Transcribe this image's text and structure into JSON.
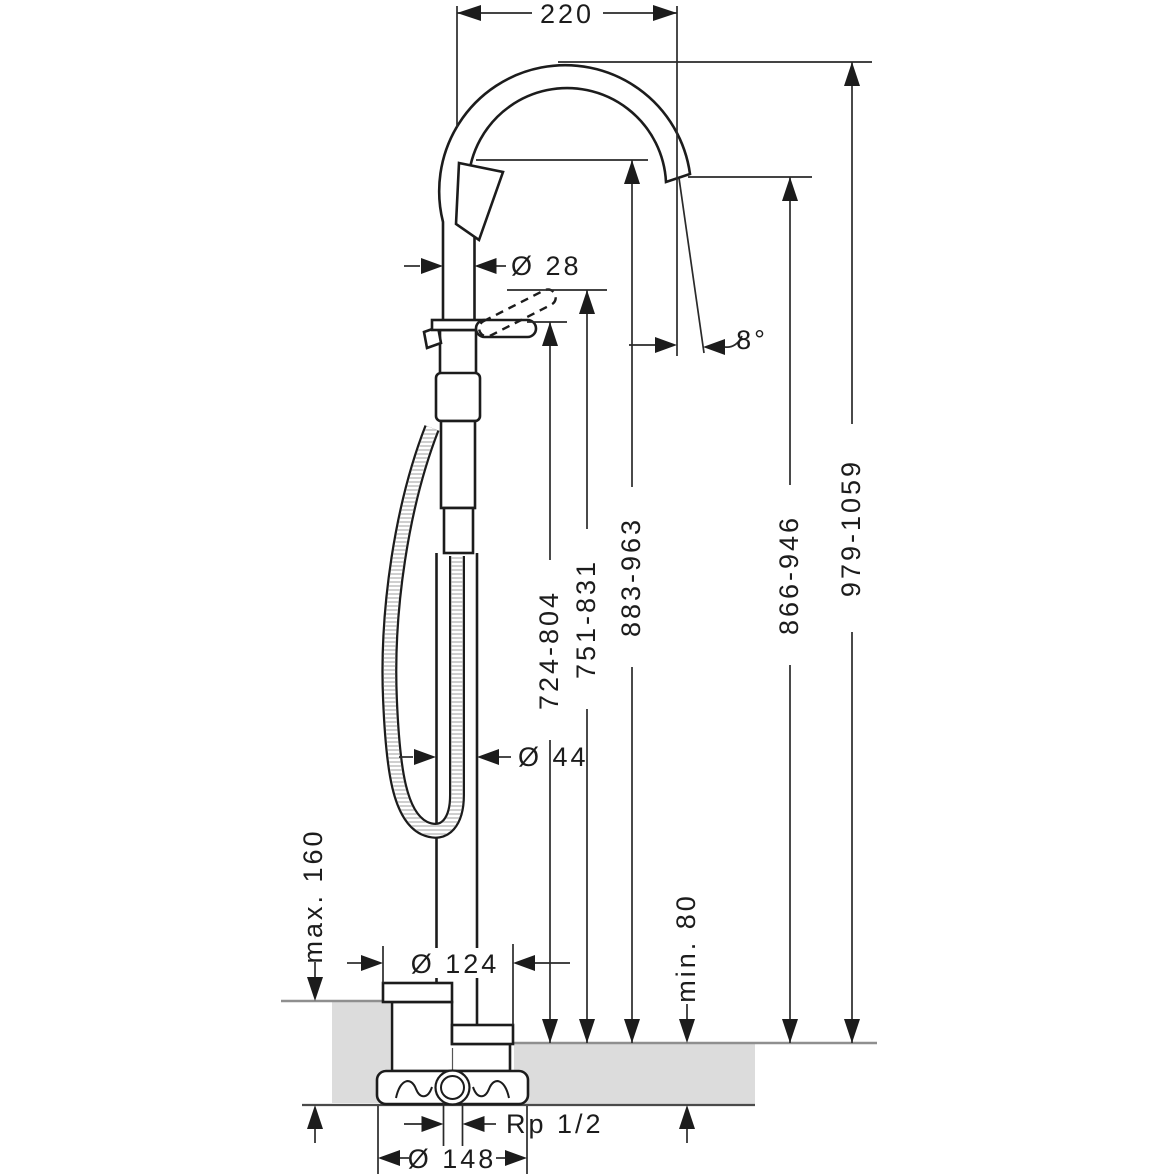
{
  "drawing": {
    "type": "technical-dimension-drawing",
    "subject": "freestanding bath mixer with hand shower, floor-mounted",
    "colors": {
      "line": "#1c1c1c",
      "dimension_line": "#2a2a2a",
      "floor_fill": "#dcdcdc",
      "floor_edge": "#8f8f8f",
      "background": "#ffffff"
    },
    "dimensions": {
      "top_width": "220",
      "pipe_diameter": "Ø 28",
      "spout_angle": "8°",
      "handle_height_range": "724-804",
      "handle_raised_height_range": "751-831",
      "spout_outlet_height_range": "883-963",
      "spout_tip_height_range": "866-946",
      "total_height_range": "979-1059",
      "column_diameter": "Ø 44",
      "floor_buildup_max": "max. 160",
      "floor_buildup_min": "min. 80",
      "escutcheon_diameter": "Ø 124",
      "connection_thread": "Rp 1/2",
      "base_flange_diameter": "Ø 148"
    }
  }
}
